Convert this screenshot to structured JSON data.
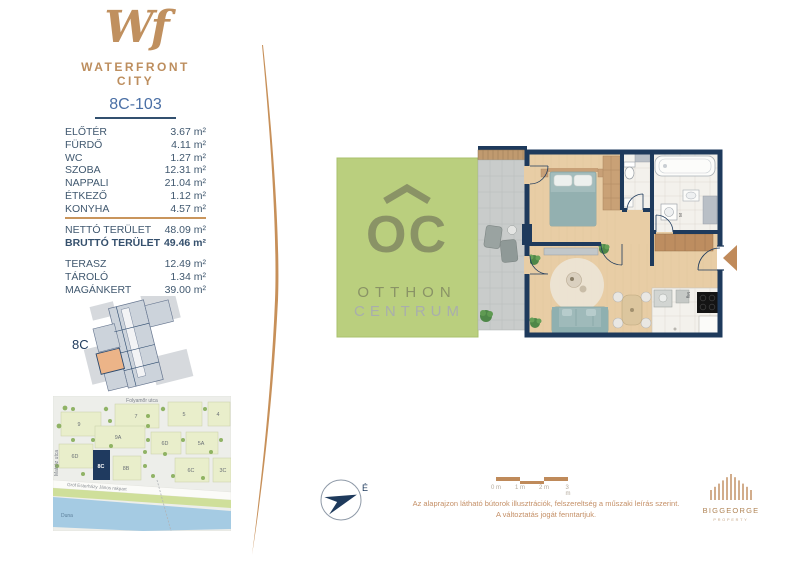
{
  "brand": {
    "monogram": "Wf",
    "name": "WATERFRONT CITY"
  },
  "unit": {
    "title": "8C-103",
    "rooms": [
      {
        "name": "ELŐTÉR",
        "area": "3.67 m²"
      },
      {
        "name": "FÜRDŐ",
        "area": "4.11 m²"
      },
      {
        "name": "WC",
        "area": "1.27 m²"
      },
      {
        "name": "SZOBA",
        "area": "12.31 m²"
      },
      {
        "name": "NAPPALI",
        "area": "21.04 m²"
      },
      {
        "name": "ÉTKEZŐ",
        "area": "1.12 m²"
      },
      {
        "name": "KONYHA",
        "area": "4.57 m²"
      }
    ],
    "totals": [
      {
        "name": "NETTÓ TERÜLET",
        "area": "48.09 m²"
      },
      {
        "name": "BRUTTÓ TERÜLET",
        "area": "49.46 m²"
      }
    ],
    "extras": [
      {
        "name": "TERASZ",
        "area": "12.49 m²"
      },
      {
        "name": "TÁROLÓ",
        "area": "1.34 m²"
      },
      {
        "name": "MAGÁNKERT",
        "area": "39.00 m²"
      }
    ]
  },
  "level_plan": {
    "label": "8C"
  },
  "map": {
    "street_top": "Folyamőr utca",
    "street_left": "Matróz utca",
    "street_embankment": "Gróf Esterházy János rakpart",
    "river": "Duna",
    "buildings": [
      "9",
      "7",
      "5",
      "4",
      "9A",
      "6D",
      "5A",
      "6D",
      "8C",
      "8B",
      "6C",
      "3C"
    ]
  },
  "watermark": {
    "monogram": "OC",
    "line1": "OTTHON",
    "line2": "CENTRUM"
  },
  "floorplan": {
    "washer": "M",
    "dishwasher": "Mg"
  },
  "compass": {
    "north": "É"
  },
  "scalebar": {
    "ticks": [
      "0 m",
      "1 m",
      "2 m",
      "3 m"
    ]
  },
  "disclaimer": {
    "line1": "Az alaprajzon látható bútorok illusztrációk, felszereltség a műszaki leírás szerint.",
    "line2": "A változtatás jogát fenntartjuk."
  },
  "developer": {
    "name": "BIGGEORGE",
    "subtitle": "PROPERTY"
  },
  "colors": {
    "accent": "#BF8A5A",
    "navy": "#1E3A5C",
    "garden": "#BACF7E"
  }
}
